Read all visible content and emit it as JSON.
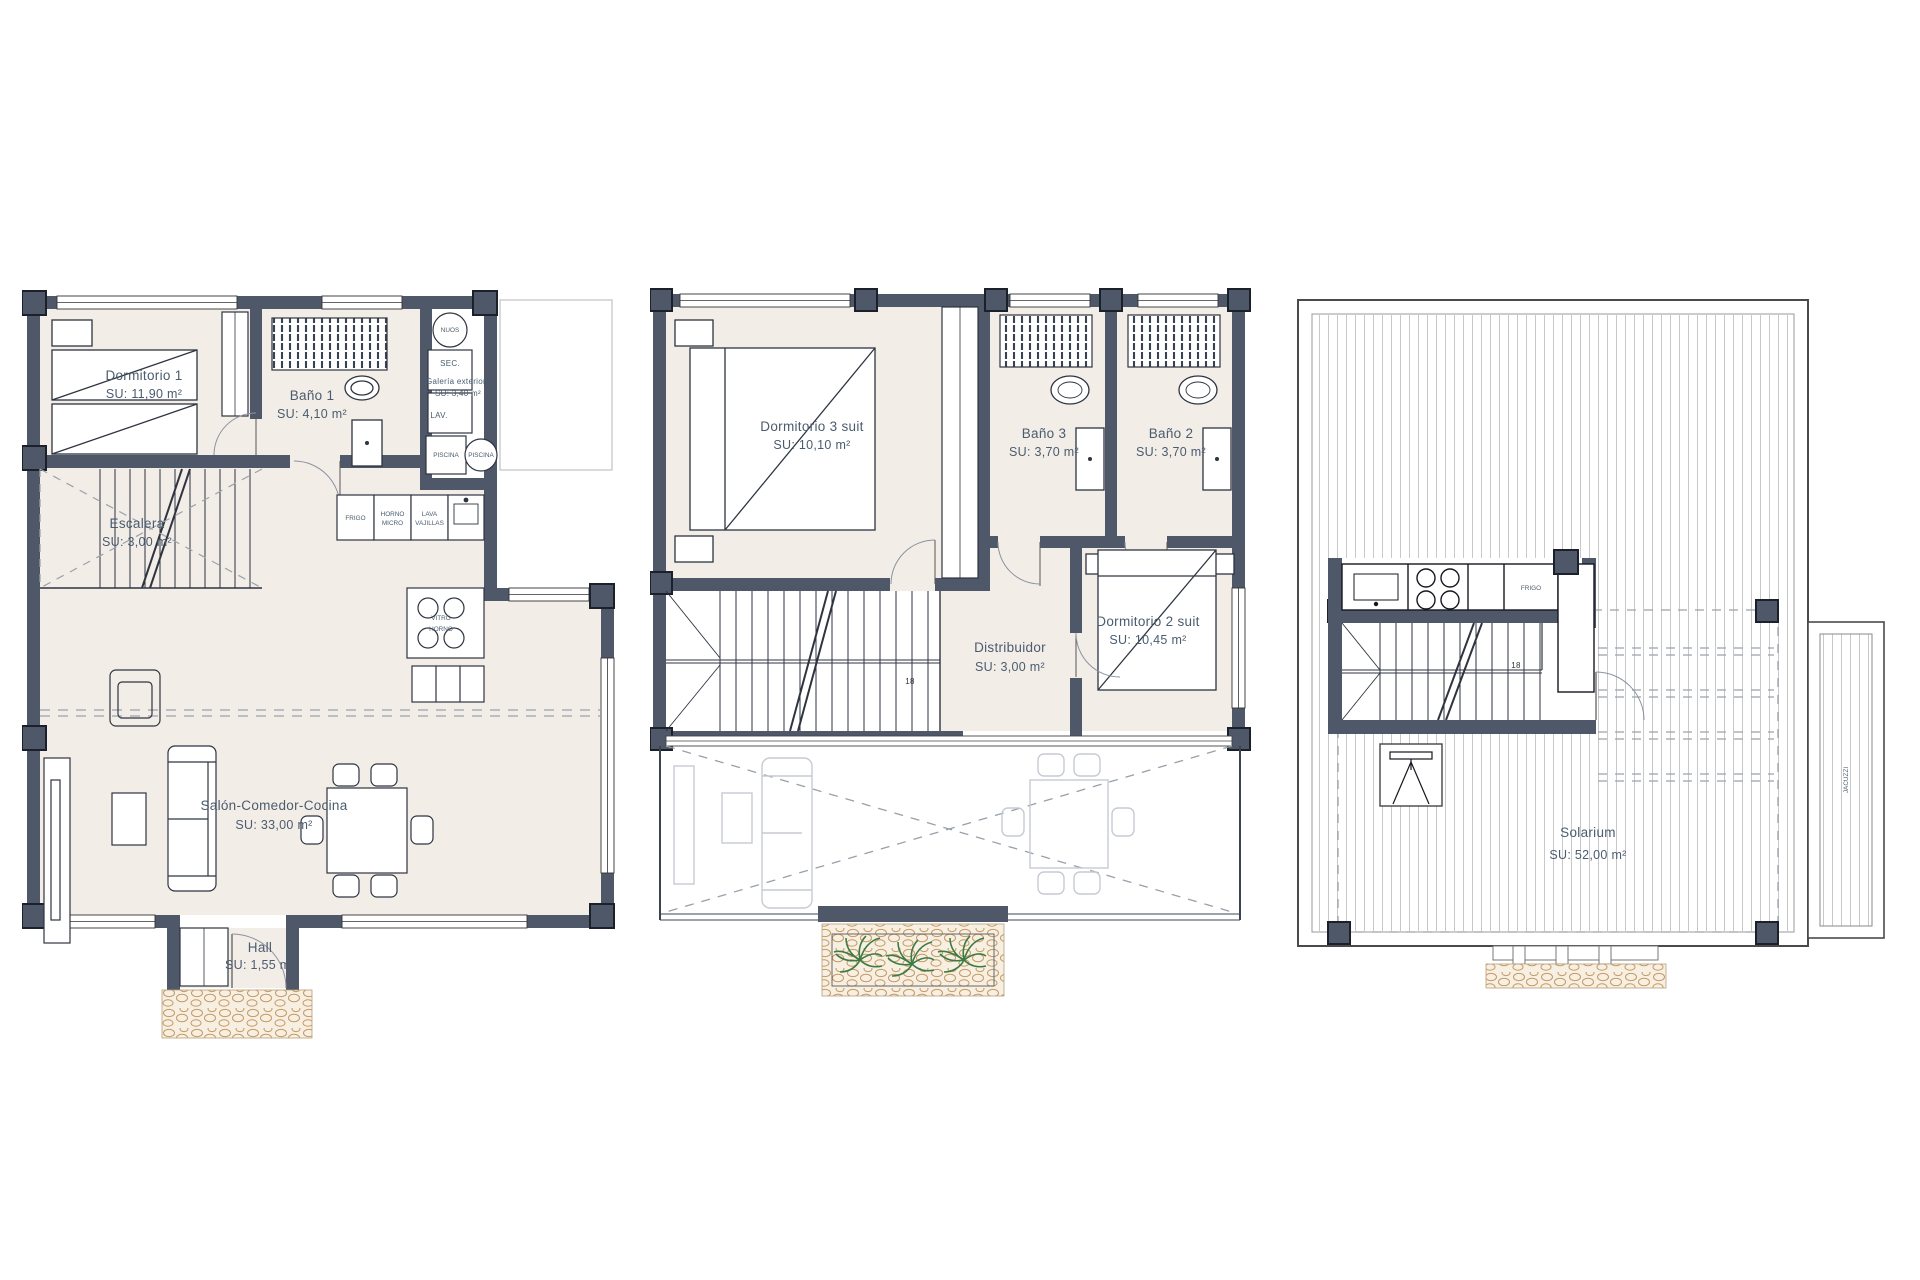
{
  "sheet": {
    "background": "#ffffff"
  },
  "colors": {
    "wall": "#4e5869",
    "room_fill": "#f3ede8",
    "label_text": "#4a5c6e",
    "ghost_furniture": "#c6cbd2",
    "deck_line": "#c8c8c8",
    "plant_green": "#3e7b44",
    "stone_brown": "#c59a66"
  },
  "plans": {
    "ground": {
      "rooms": {
        "dormitorio1": {
          "name": "Dormitorio 1",
          "area": "SU: 11,90 m²"
        },
        "bano1": {
          "name": "Baño 1",
          "area": "SU: 4,10 m²"
        },
        "galeria": {
          "name": "Galería exterior",
          "area": "SU: 3,40 m²"
        },
        "escalera": {
          "name": "Escalera",
          "area": "SU: 3,00 m²"
        },
        "salon": {
          "name": "Salón-Comedor-Cocina",
          "area": "SU: 33,00 m²"
        },
        "hall": {
          "name": "Hall",
          "area": "SU: 1,55 m²"
        }
      },
      "labels": {
        "nuos": "NUOS",
        "sec": "SEC.",
        "lav": "LAV.",
        "piscina1": "PISCINA",
        "piscina2": "PISCINA",
        "frigo": "FRIGO",
        "horno": "HORNO",
        "micro": "MICRO",
        "lava": "LAVA",
        "vajillas": "VAJILLAS",
        "vitro": "VITRO",
        "vitro_horno": "HORNO"
      }
    },
    "first": {
      "rooms": {
        "dormitorio3": {
          "name": "Dormitorio 3 suit",
          "area": "SU: 10,10 m²"
        },
        "bano3": {
          "name": "Baño 3",
          "area": "SU: 3,70 m²"
        },
        "bano2": {
          "name": "Baño 2",
          "area": "SU: 3,70 m²"
        },
        "dormitorio2": {
          "name": "Dormitorio 2 suit",
          "area": "SU: 10,45 m²"
        },
        "distribuidor": {
          "name": "Distribuidor",
          "area": "SU: 3,00 m²"
        }
      },
      "labels": {
        "steps": "18"
      }
    },
    "solarium": {
      "rooms": {
        "solarium": {
          "name": "Solarium",
          "area": "SU: 52,00 m²"
        }
      },
      "labels": {
        "frigo": "FRIGO",
        "jacuzzi": "JACUZZI",
        "steps": "18"
      }
    }
  }
}
